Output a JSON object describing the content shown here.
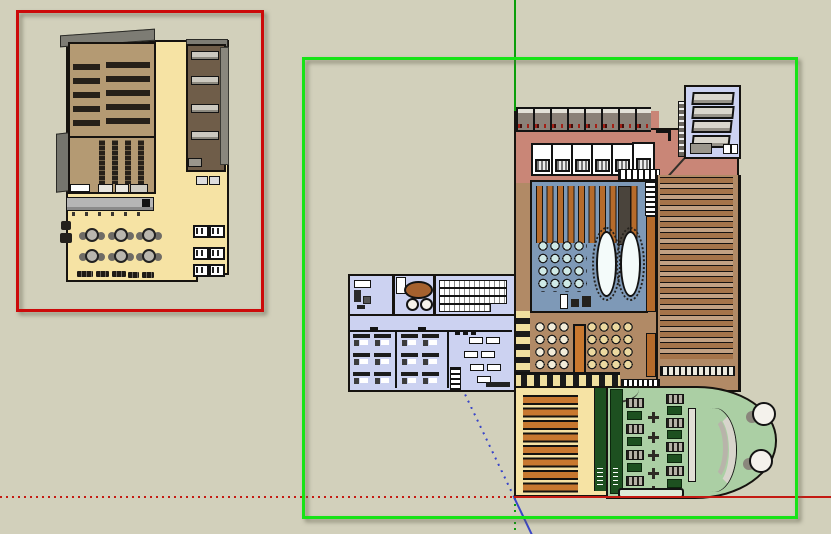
{
  "viewport": {
    "app_kind": "3d-modeling-viewport",
    "view": "top plan view of two building models",
    "visible_text": "none"
  },
  "colors": {
    "bg": "#d2d0bb",
    "selred": "#cc0a0a",
    "selgreen": "#17e317",
    "axred": "#c41a12",
    "axgreen": "#0b9e0b",
    "axblue": "#3a46c8",
    "cream": "#f6e3a4",
    "tan": "#b49a73",
    "darkwood": "#6f5d49",
    "salmon": "#c98677",
    "blue": "#7e99b7",
    "cyan": "#cfe9e6",
    "orange": "#b66b2b",
    "orange2": "#c8782f",
    "lav": "#ccd2f1",
    "brown": "#b18a66",
    "shelfbg": "#c2a183",
    "shelfbar": "#a5744a",
    "green": "#abcfa4",
    "dgreen": "#1d5020",
    "counter": "#b5b5b5"
  },
  "selections": {
    "red_box": "red selection rectangle around left floor-plan model",
    "green_box": "green selection rectangle around right floor-plan model"
  },
  "axes": {
    "origin": "x 515 / y 497 px",
    "green_axis": "vertical: solid above origin, dotted below",
    "red_axis": "horizontal: solid right of origin, dotted left",
    "blue_axis": "diagonal: dotted above origin, solid below"
  },
  "models": {
    "left_plan": "auditorium building: two tan seating rooms, dark wood shelf closet, cream floor with service counter, six round cafe tables, striped twin tables, bottom benches",
    "right_plan": "campus building: toilet block (8 dark stalls with red fixtures, 6 white WC stalls), blue library room (10 shelf stripes, chair grid, 2 oval tables), tall bookshelf wing (17 shelf bars), top-right stair room with 4 tables, lavender office block (offices, meeting room, desk rows), cream hall with 8 orange tables, semicircular green auditorium with benches, plant crosses, curved tier rows and two round tables"
  }
}
